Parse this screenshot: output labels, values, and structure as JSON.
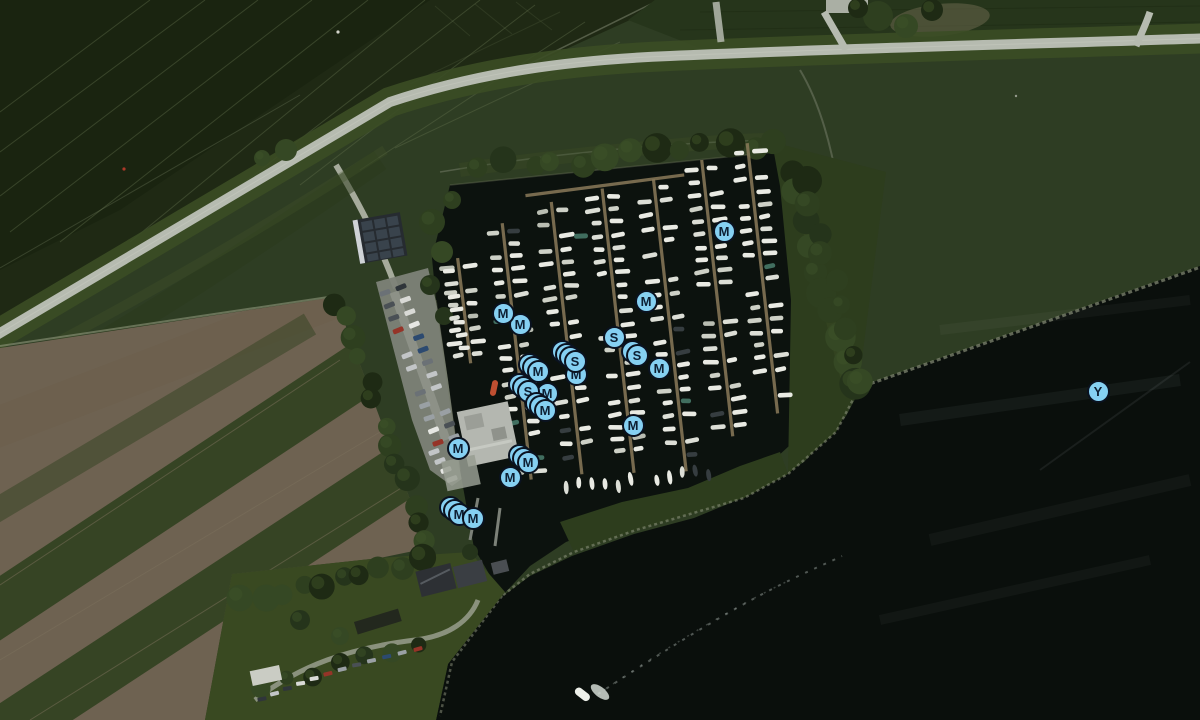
{
  "map": {
    "kind": "satellite-map-of-marina",
    "colors": {
      "marker_fill": "#85d0f2",
      "marker_ring": "#0a1220",
      "marker_letter": "#0d1f33"
    },
    "markers": [
      {
        "letter": "M",
        "x": 520,
        "y": 324,
        "stack": 0
      },
      {
        "letter": "M",
        "x": 503,
        "y": 313,
        "stack": 0
      },
      {
        "letter": "M",
        "x": 646,
        "y": 301,
        "stack": 0
      },
      {
        "letter": "M",
        "x": 724,
        "y": 231,
        "stack": 0
      },
      {
        "letter": "S",
        "x": 614,
        "y": 337,
        "stack": 0
      },
      {
        "letter": "S",
        "x": 637,
        "y": 355,
        "stack": 1
      },
      {
        "letter": "M",
        "x": 659,
        "y": 368,
        "stack": 0
      },
      {
        "letter": "M",
        "x": 576,
        "y": 374,
        "stack": 0
      },
      {
        "letter": "S",
        "x": 575,
        "y": 361,
        "stack": 3
      },
      {
        "letter": "M",
        "x": 538,
        "y": 371,
        "stack": 2
      },
      {
        "letter": "M",
        "x": 547,
        "y": 393,
        "stack": 0
      },
      {
        "letter": "S",
        "x": 528,
        "y": 391,
        "stack": 2
      },
      {
        "letter": "M",
        "x": 545,
        "y": 410,
        "stack": 2
      },
      {
        "letter": "M",
        "x": 633,
        "y": 425,
        "stack": 0
      },
      {
        "letter": "M",
        "x": 458,
        "y": 448,
        "stack": 0
      },
      {
        "letter": "M",
        "x": 528,
        "y": 462,
        "stack": 2
      },
      {
        "letter": "M",
        "x": 510,
        "y": 477,
        "stack": 0
      },
      {
        "letter": "M",
        "x": 459,
        "y": 514,
        "stack": 2
      },
      {
        "letter": "M",
        "x": 473,
        "y": 518,
        "stack": 0
      },
      {
        "letter": "Y",
        "x": 1098,
        "y": 391,
        "stack": 0
      }
    ]
  }
}
